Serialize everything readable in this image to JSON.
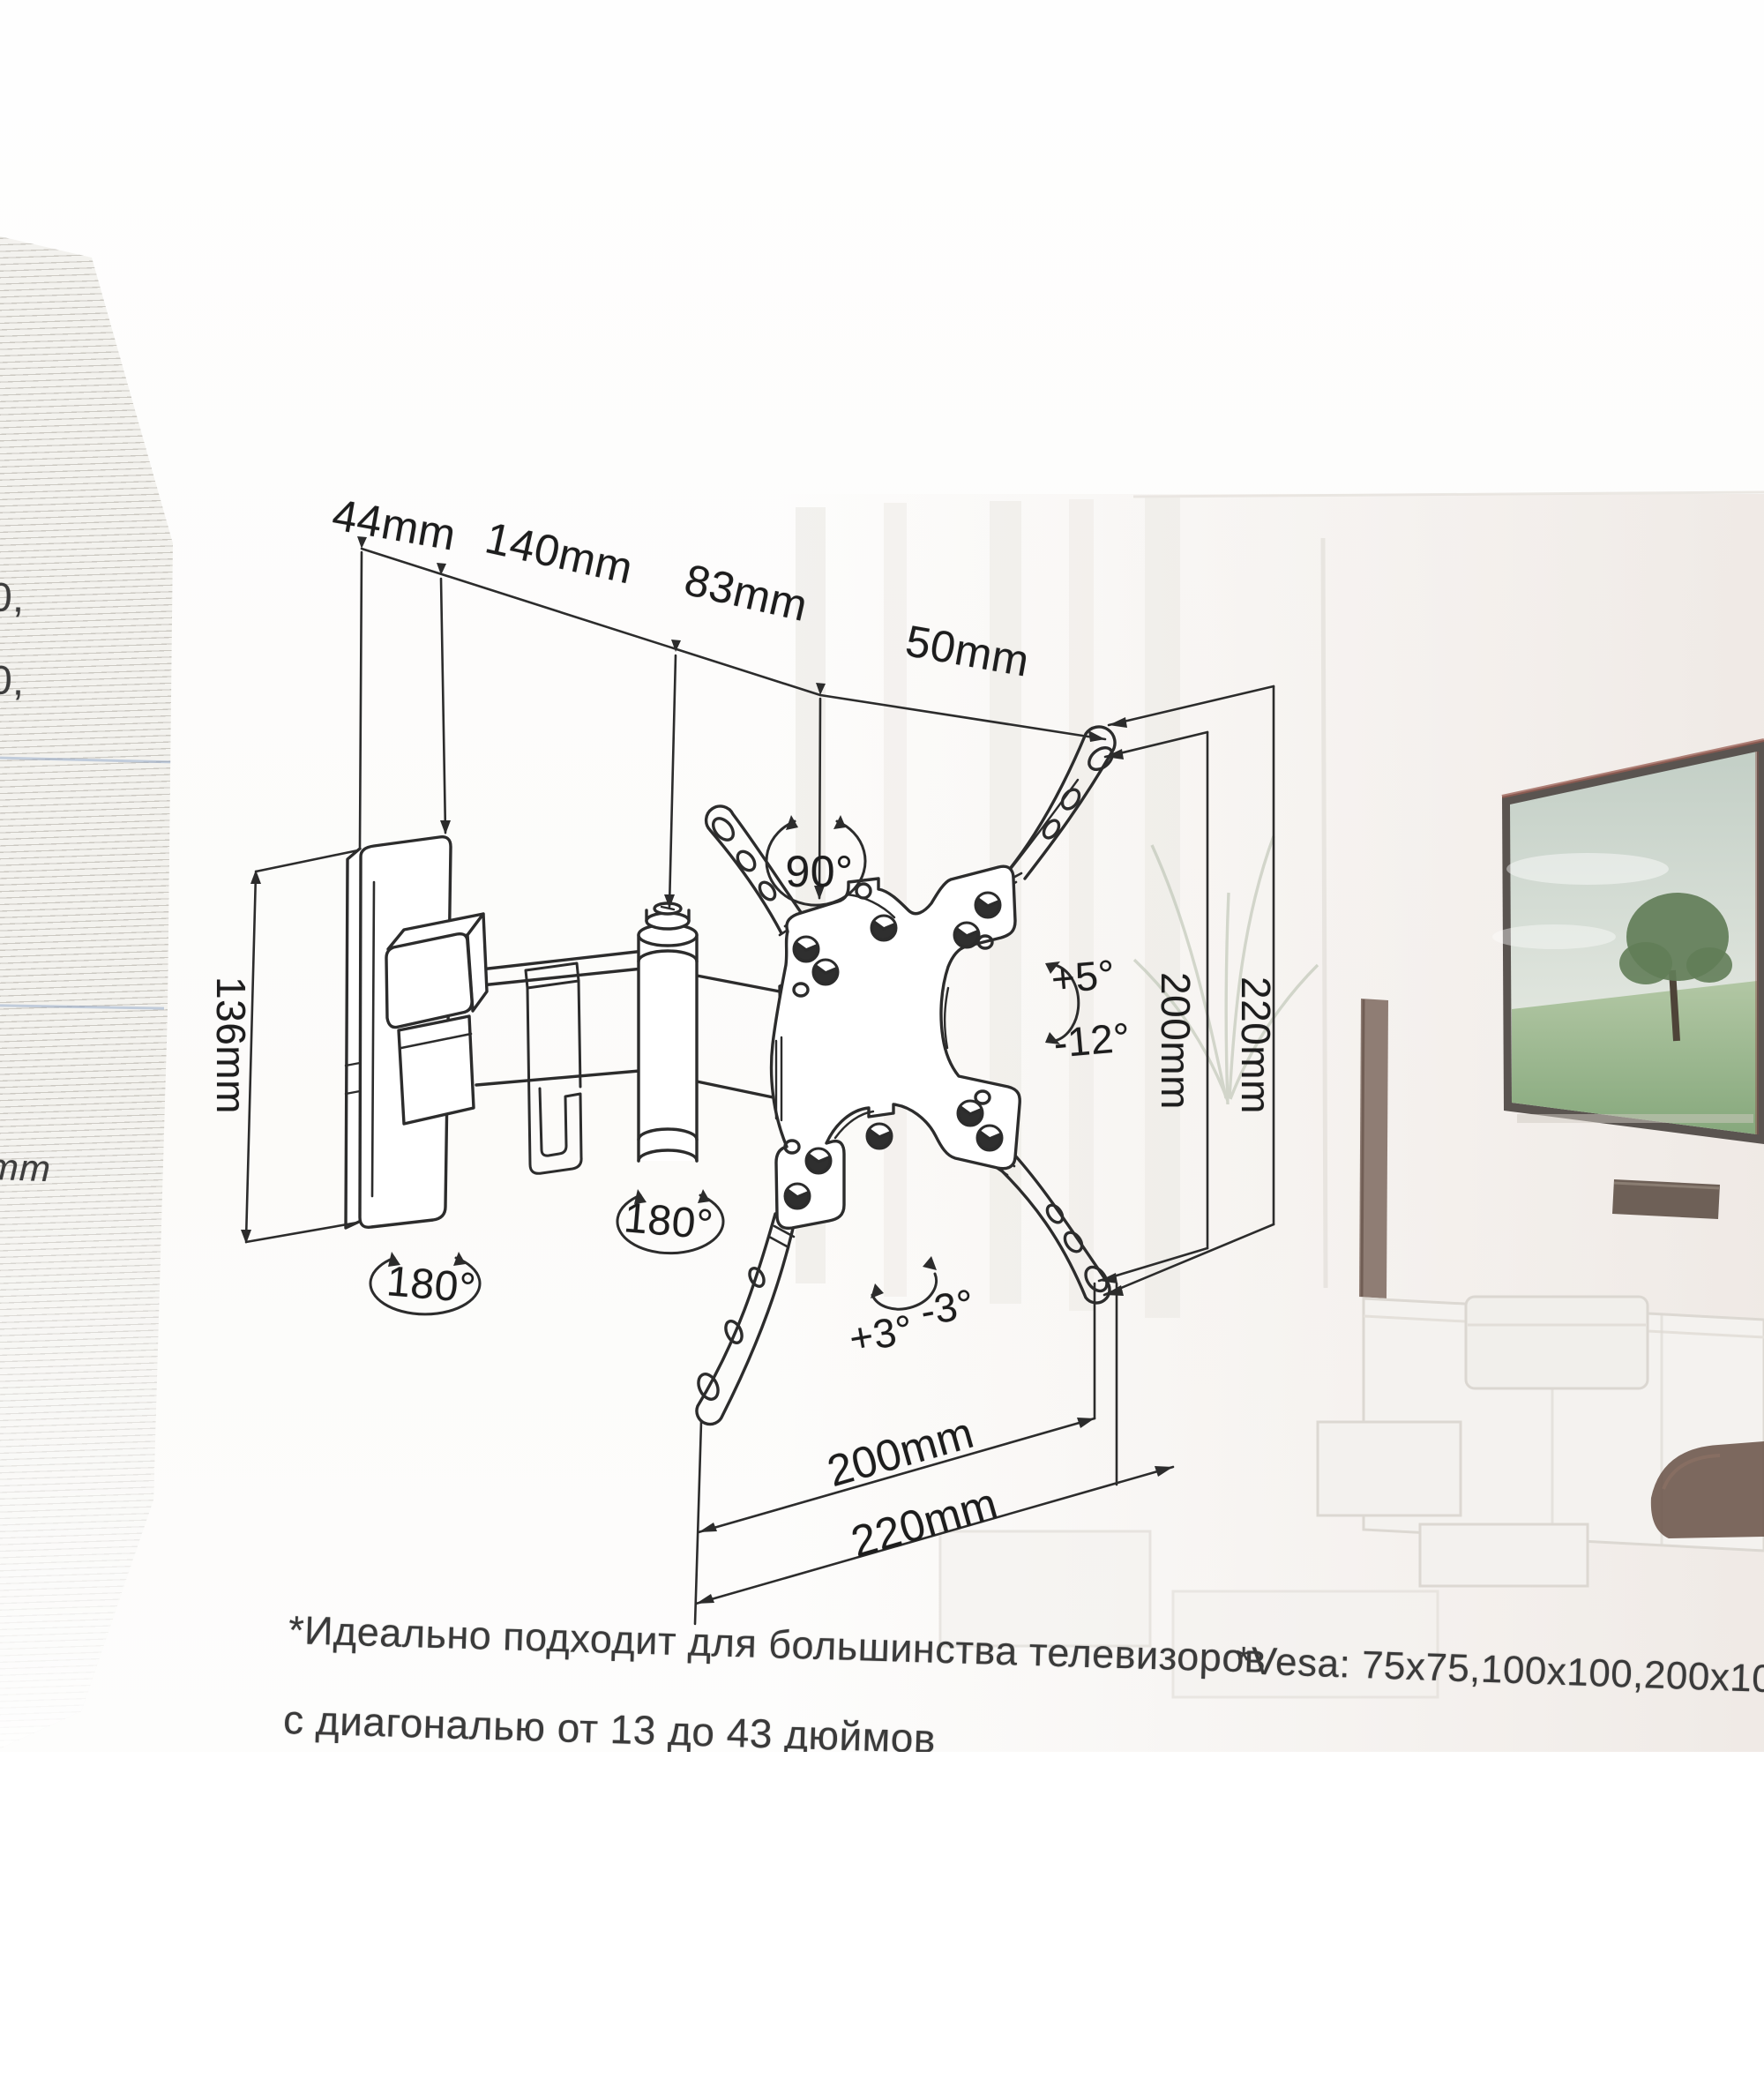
{
  "diagram": {
    "dims": {
      "d44": "44mm",
      "d140": "140mm",
      "d83": "83mm",
      "d50": "50mm",
      "d136": "136mm",
      "v200": "200mm",
      "v220": "220mm",
      "h200": "200mm",
      "h220": "220mm"
    },
    "angles": {
      "swivel": "90°",
      "elbow": "180°",
      "wall": "180°",
      "tilt_up": "+5°",
      "tilt_down": "-12°",
      "roll_plus": "+3°",
      "roll_minus": "-3°"
    }
  },
  "footnotes": {
    "ru_line1": "*Идеально подходит для большинства телевизоров",
    "ru_line2": "с диагональю от 13 до 43 дюймов",
    "vesa": "*Vesa: 75x75,100x100,200x100,200x2"
  },
  "left_edge_fragments": {
    "top": "0,",
    "mid": "0,",
    "bottom": "mm"
  },
  "colors": {
    "line_art": "#2c2c2c",
    "photo_sky": "#cdd6cd",
    "photo_grass": "#8fae86",
    "pillar": "#7d685e",
    "soundbar": "#6e6057",
    "couch": "#6b544a",
    "stripe": "#c9c6c0"
  }
}
